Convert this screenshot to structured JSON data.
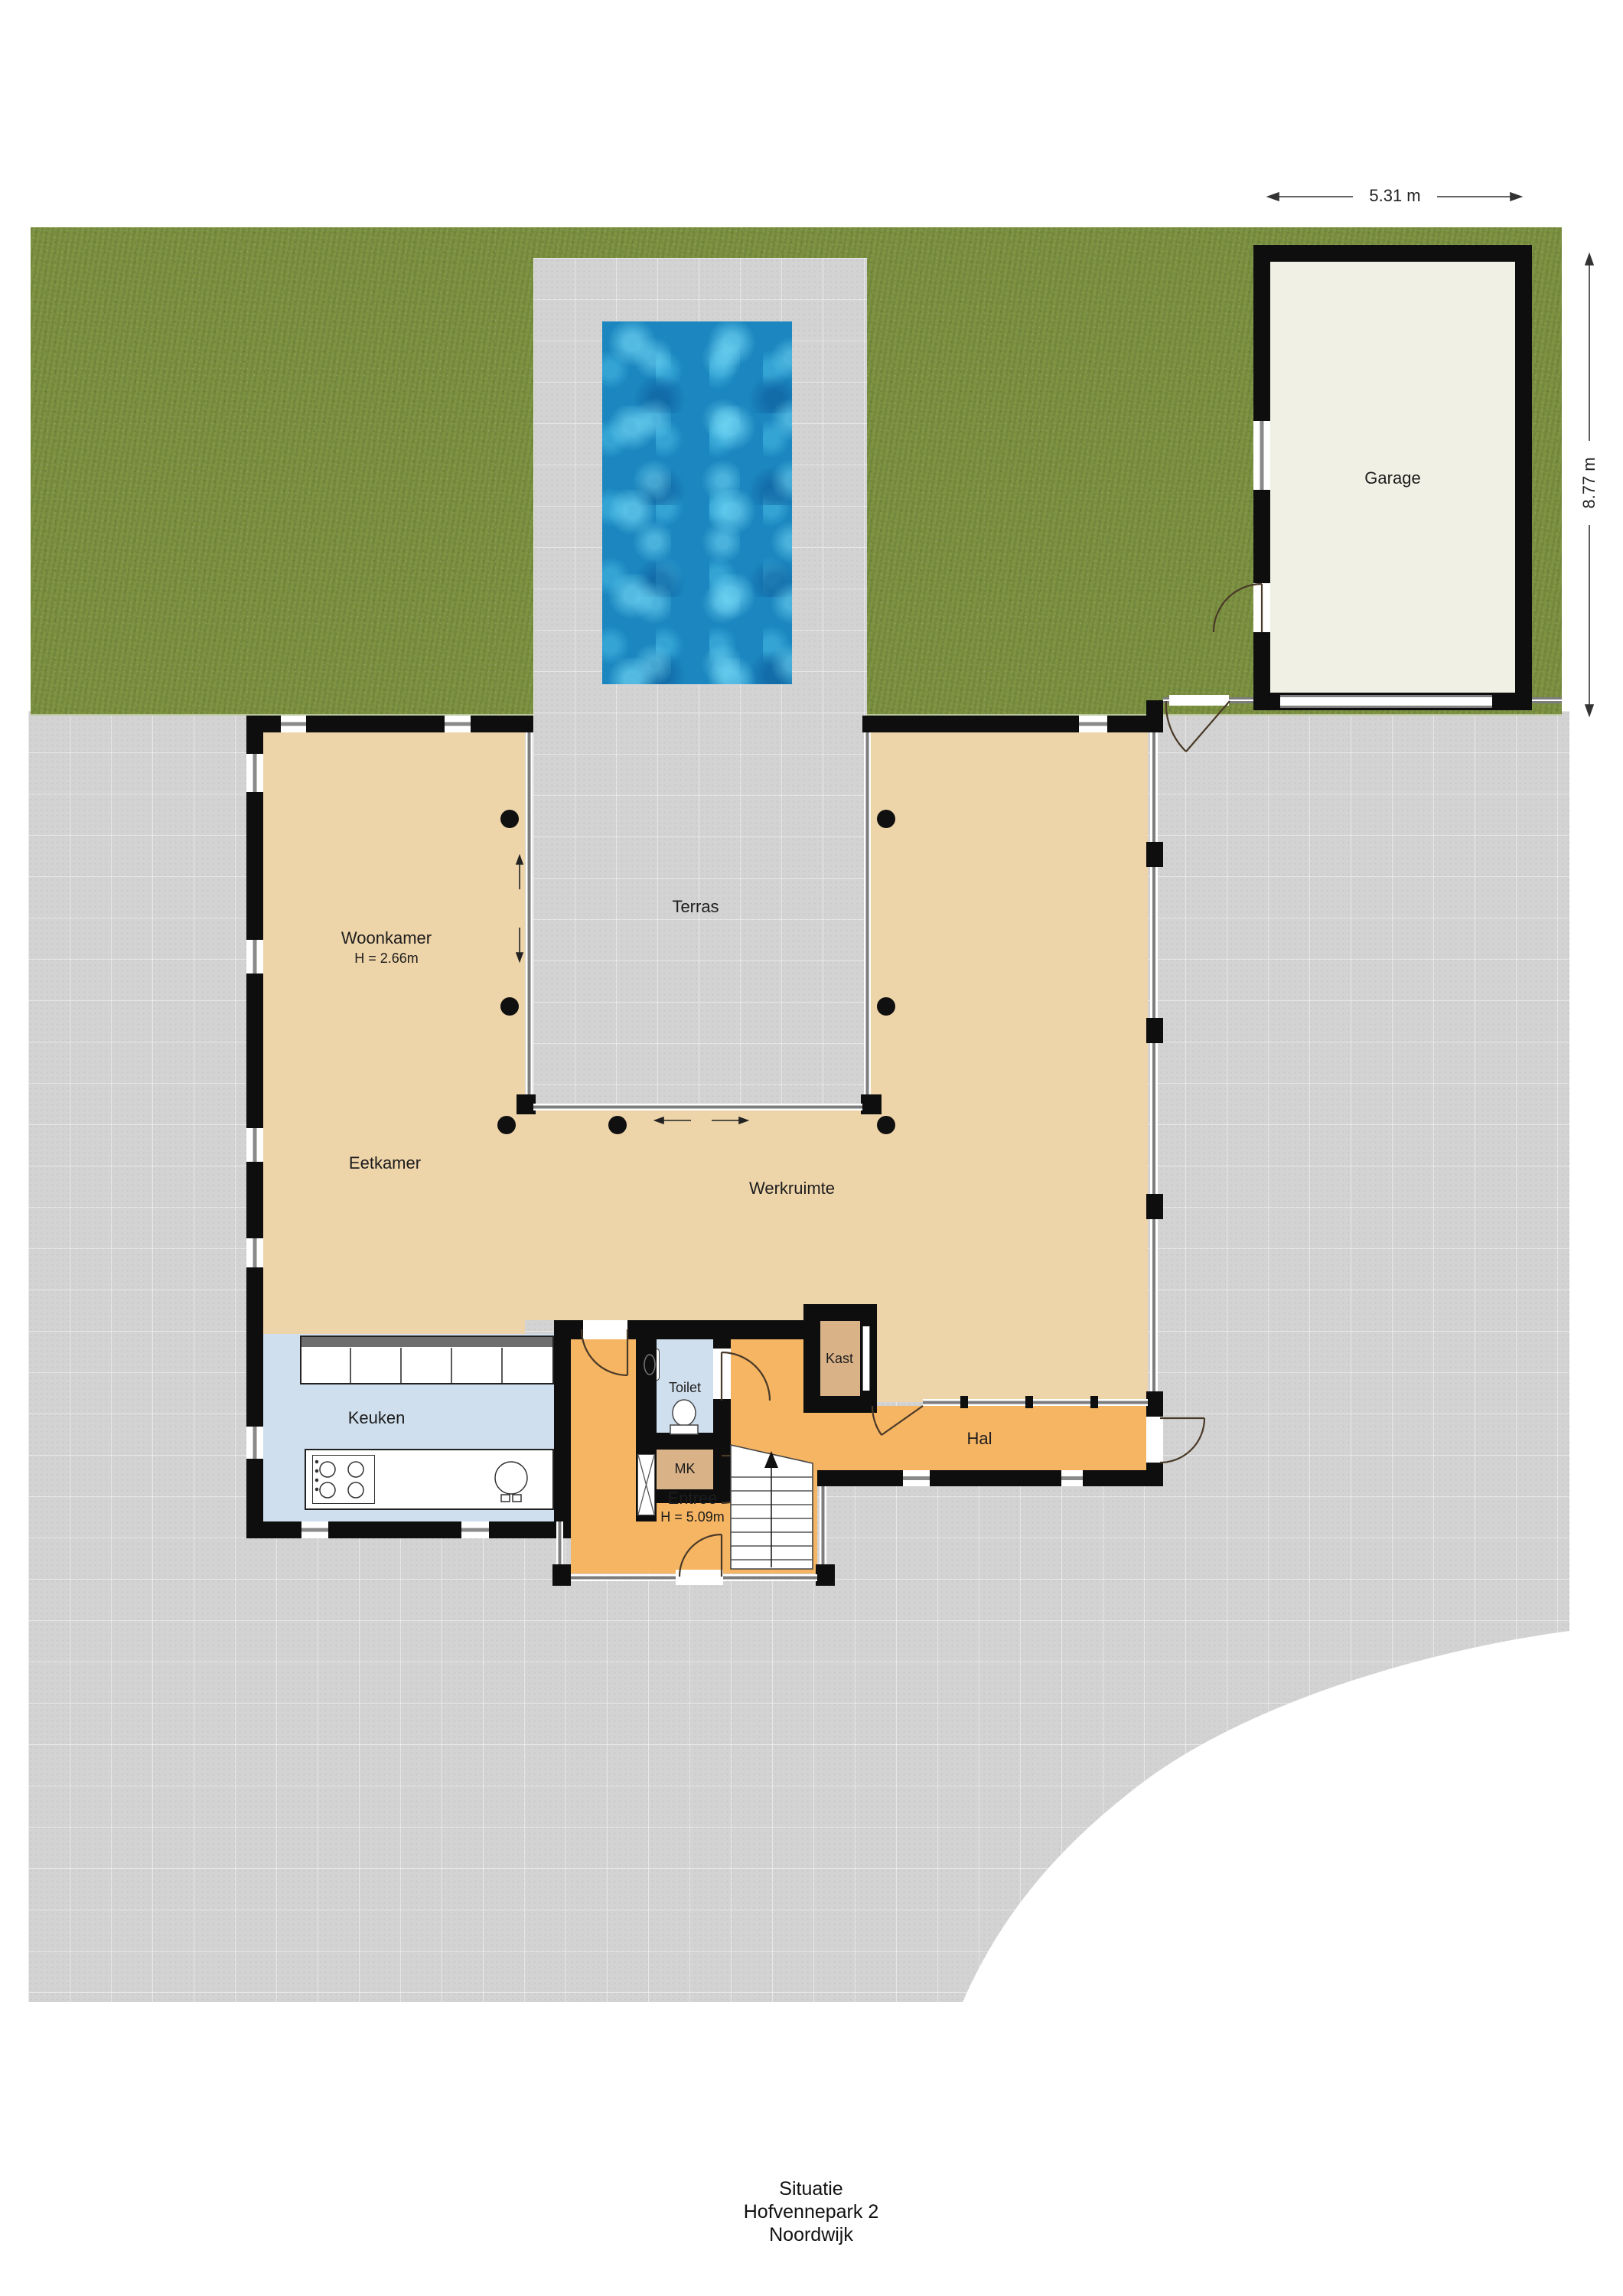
{
  "caption": {
    "line1": "Situatie",
    "line2": "Hofvennepark 2",
    "line3": "Noordwijk"
  },
  "dimensions": {
    "garage_width": "5.31 m",
    "garage_depth": "8.77 m"
  },
  "rooms": {
    "woonkamer": {
      "name": "Woonkamer",
      "height": "H = 2.66m"
    },
    "eetkamer": {
      "name": "Eetkamer"
    },
    "terras": {
      "name": "Terras"
    },
    "werkruimte": {
      "name": "Werkruimte"
    },
    "keuken": {
      "name": "Keuken"
    },
    "toilet": {
      "name": "Toilet"
    },
    "mk": {
      "name": "MK"
    },
    "kast": {
      "name": "Kast"
    },
    "hal": {
      "name": "Hal"
    },
    "entree": {
      "name": "Entree",
      "height": "H = 5.09m"
    },
    "garage": {
      "name": "Garage"
    }
  },
  "colors": {
    "wall": "#0e0e0e",
    "grass": "#7c9042",
    "pavement": "#d3d3d3",
    "pool_water": "#1b86bf",
    "room_living": "#eed4a9",
    "room_entry": "#f6b563",
    "room_kitchen": "#cfdfee",
    "closet": "#d9b287",
    "garage_floor": "#f1f0e5"
  }
}
